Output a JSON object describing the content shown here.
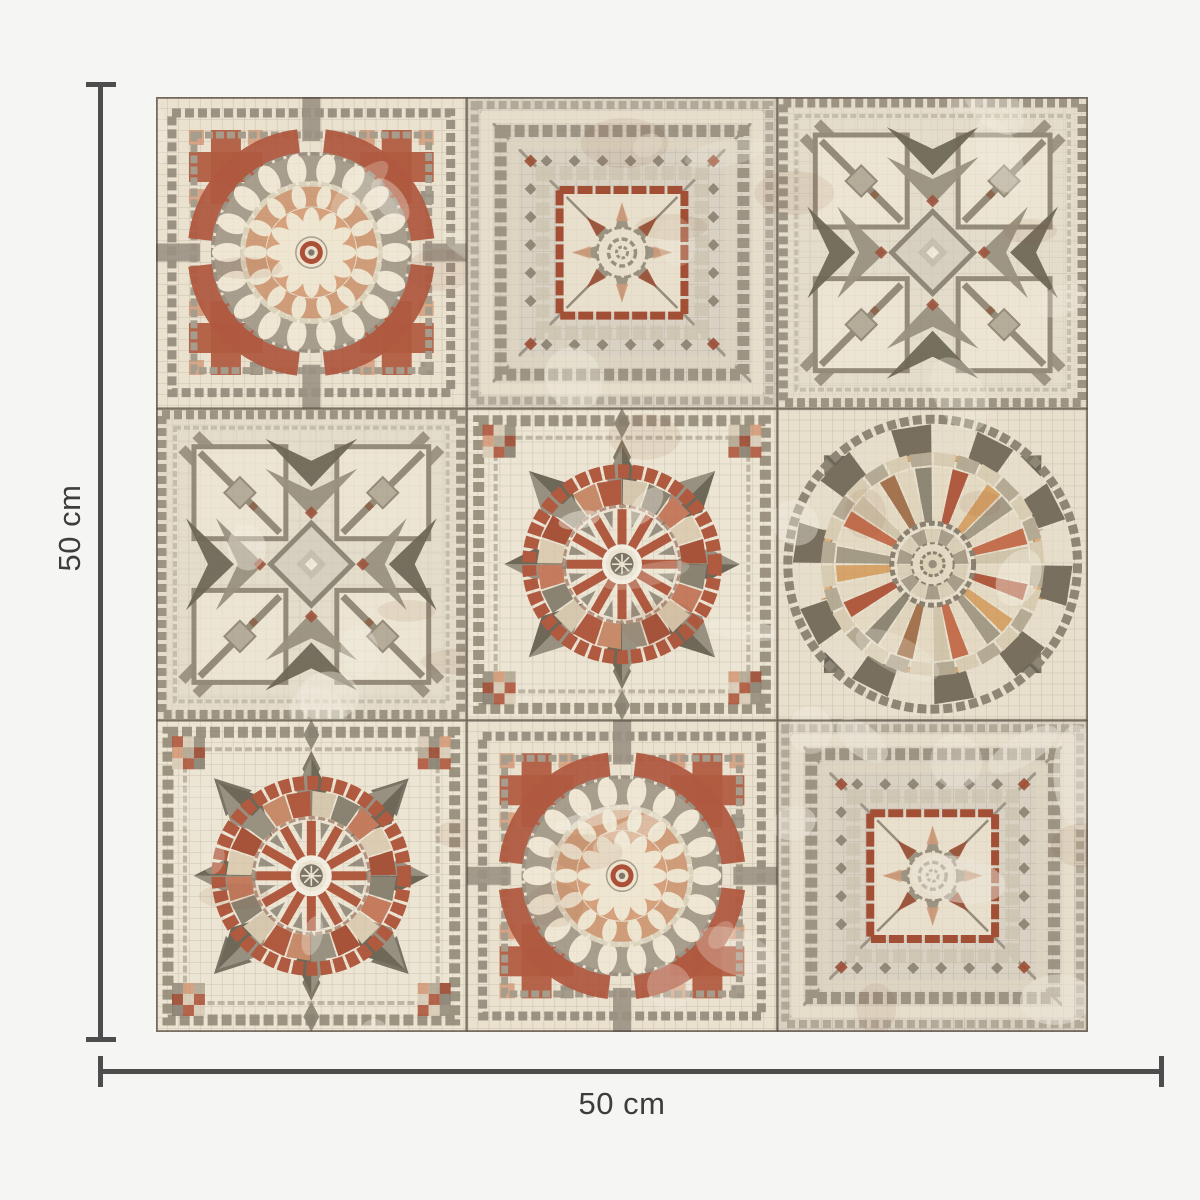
{
  "page": {
    "background_color": "#f5f5f3"
  },
  "dimensions": {
    "height_label": "50 cm",
    "width_label": "50 cm",
    "line_color": "#4d4d4d",
    "label_color": "#3d3d3d"
  },
  "mosaic_panel": {
    "rows": 3,
    "cols": 3,
    "grout_color": "#a79d8d",
    "palette": {
      "cream": "#eae2cf",
      "cream_light": "#f0e9d8",
      "taupe": "#b1a795",
      "grey": "#9a9183",
      "grey_dark": "#6e685b",
      "green_grey": "#84806f",
      "terracotta": "#b05a40",
      "rust": "#9c4c34",
      "salmon": "#d49c7b",
      "peach": "#ddae7c",
      "ochre": "#d6a368"
    },
    "tiles": [
      {
        "row": 0,
        "col": 0,
        "motif": "circle-medallion"
      },
      {
        "row": 0,
        "col": 1,
        "motif": "concentric-squares"
      },
      {
        "row": 0,
        "col": 2,
        "motif": "interlaced-star"
      },
      {
        "row": 1,
        "col": 0,
        "motif": "interlaced-star"
      },
      {
        "row": 1,
        "col": 1,
        "motif": "compass-wheel"
      },
      {
        "row": 1,
        "col": 2,
        "motif": "sunburst-medallion"
      },
      {
        "row": 2,
        "col": 0,
        "motif": "compass-wheel",
        "variant": "arrow-corners"
      },
      {
        "row": 2,
        "col": 1,
        "motif": "circle-medallion"
      },
      {
        "row": 2,
        "col": 2,
        "motif": "concentric-squares",
        "variant": "washed"
      }
    ]
  }
}
